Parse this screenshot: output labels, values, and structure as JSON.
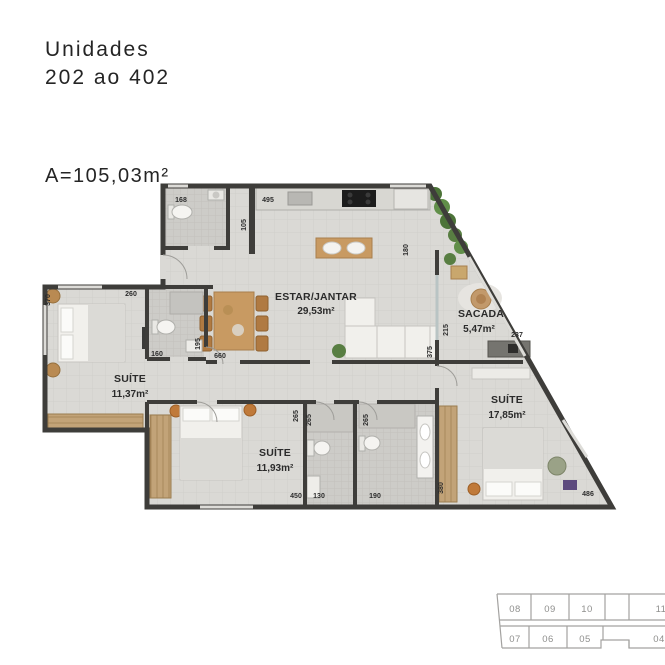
{
  "header": {
    "title_line1": "Unidades",
    "title_line2": "202 ao 402",
    "area_label": "A=105,03m²"
  },
  "floorplan": {
    "rooms": {
      "living": {
        "name": "ESTAR/JANTAR",
        "area": "29,53m²"
      },
      "sacada": {
        "name": "SACADA",
        "area": "5,47m²"
      },
      "suite1": {
        "name": "SUÍTE",
        "area": "11,37m²"
      },
      "suite2": {
        "name": "SUÍTE",
        "area": "11,93m²"
      },
      "suite3": {
        "name": "SUÍTE",
        "area": "17,85m²"
      }
    },
    "dims": {
      "lavabo_width": "168",
      "kitchen_width": "495",
      "lavabo_height": "105",
      "kitchen_opening": "180",
      "suite1_width": "260",
      "suite1_height": "370",
      "suite1_bath_width": "160",
      "hall_width": "195",
      "living_width": "660",
      "sacada_door": "215",
      "living_wall": "375",
      "sacada_counter": "237",
      "bath_depth_a": "265",
      "bath_depth_b": "265",
      "bath_depth_c": "265",
      "suite2_width": "450",
      "bath2_width": "130",
      "bath3_width": "190",
      "closet_height": "380",
      "suite3_width": "486"
    },
    "colors": {
      "wall": "#3e3d3a",
      "floor": "#dad9d5",
      "wood": "#c89a62",
      "plant_green": "#587e42",
      "label_text": "#2b2b2b"
    }
  },
  "keyplan": {
    "top_row": [
      "08",
      "09",
      "10",
      "11"
    ],
    "bottom_row": [
      "07",
      "06",
      "05",
      "04"
    ]
  }
}
